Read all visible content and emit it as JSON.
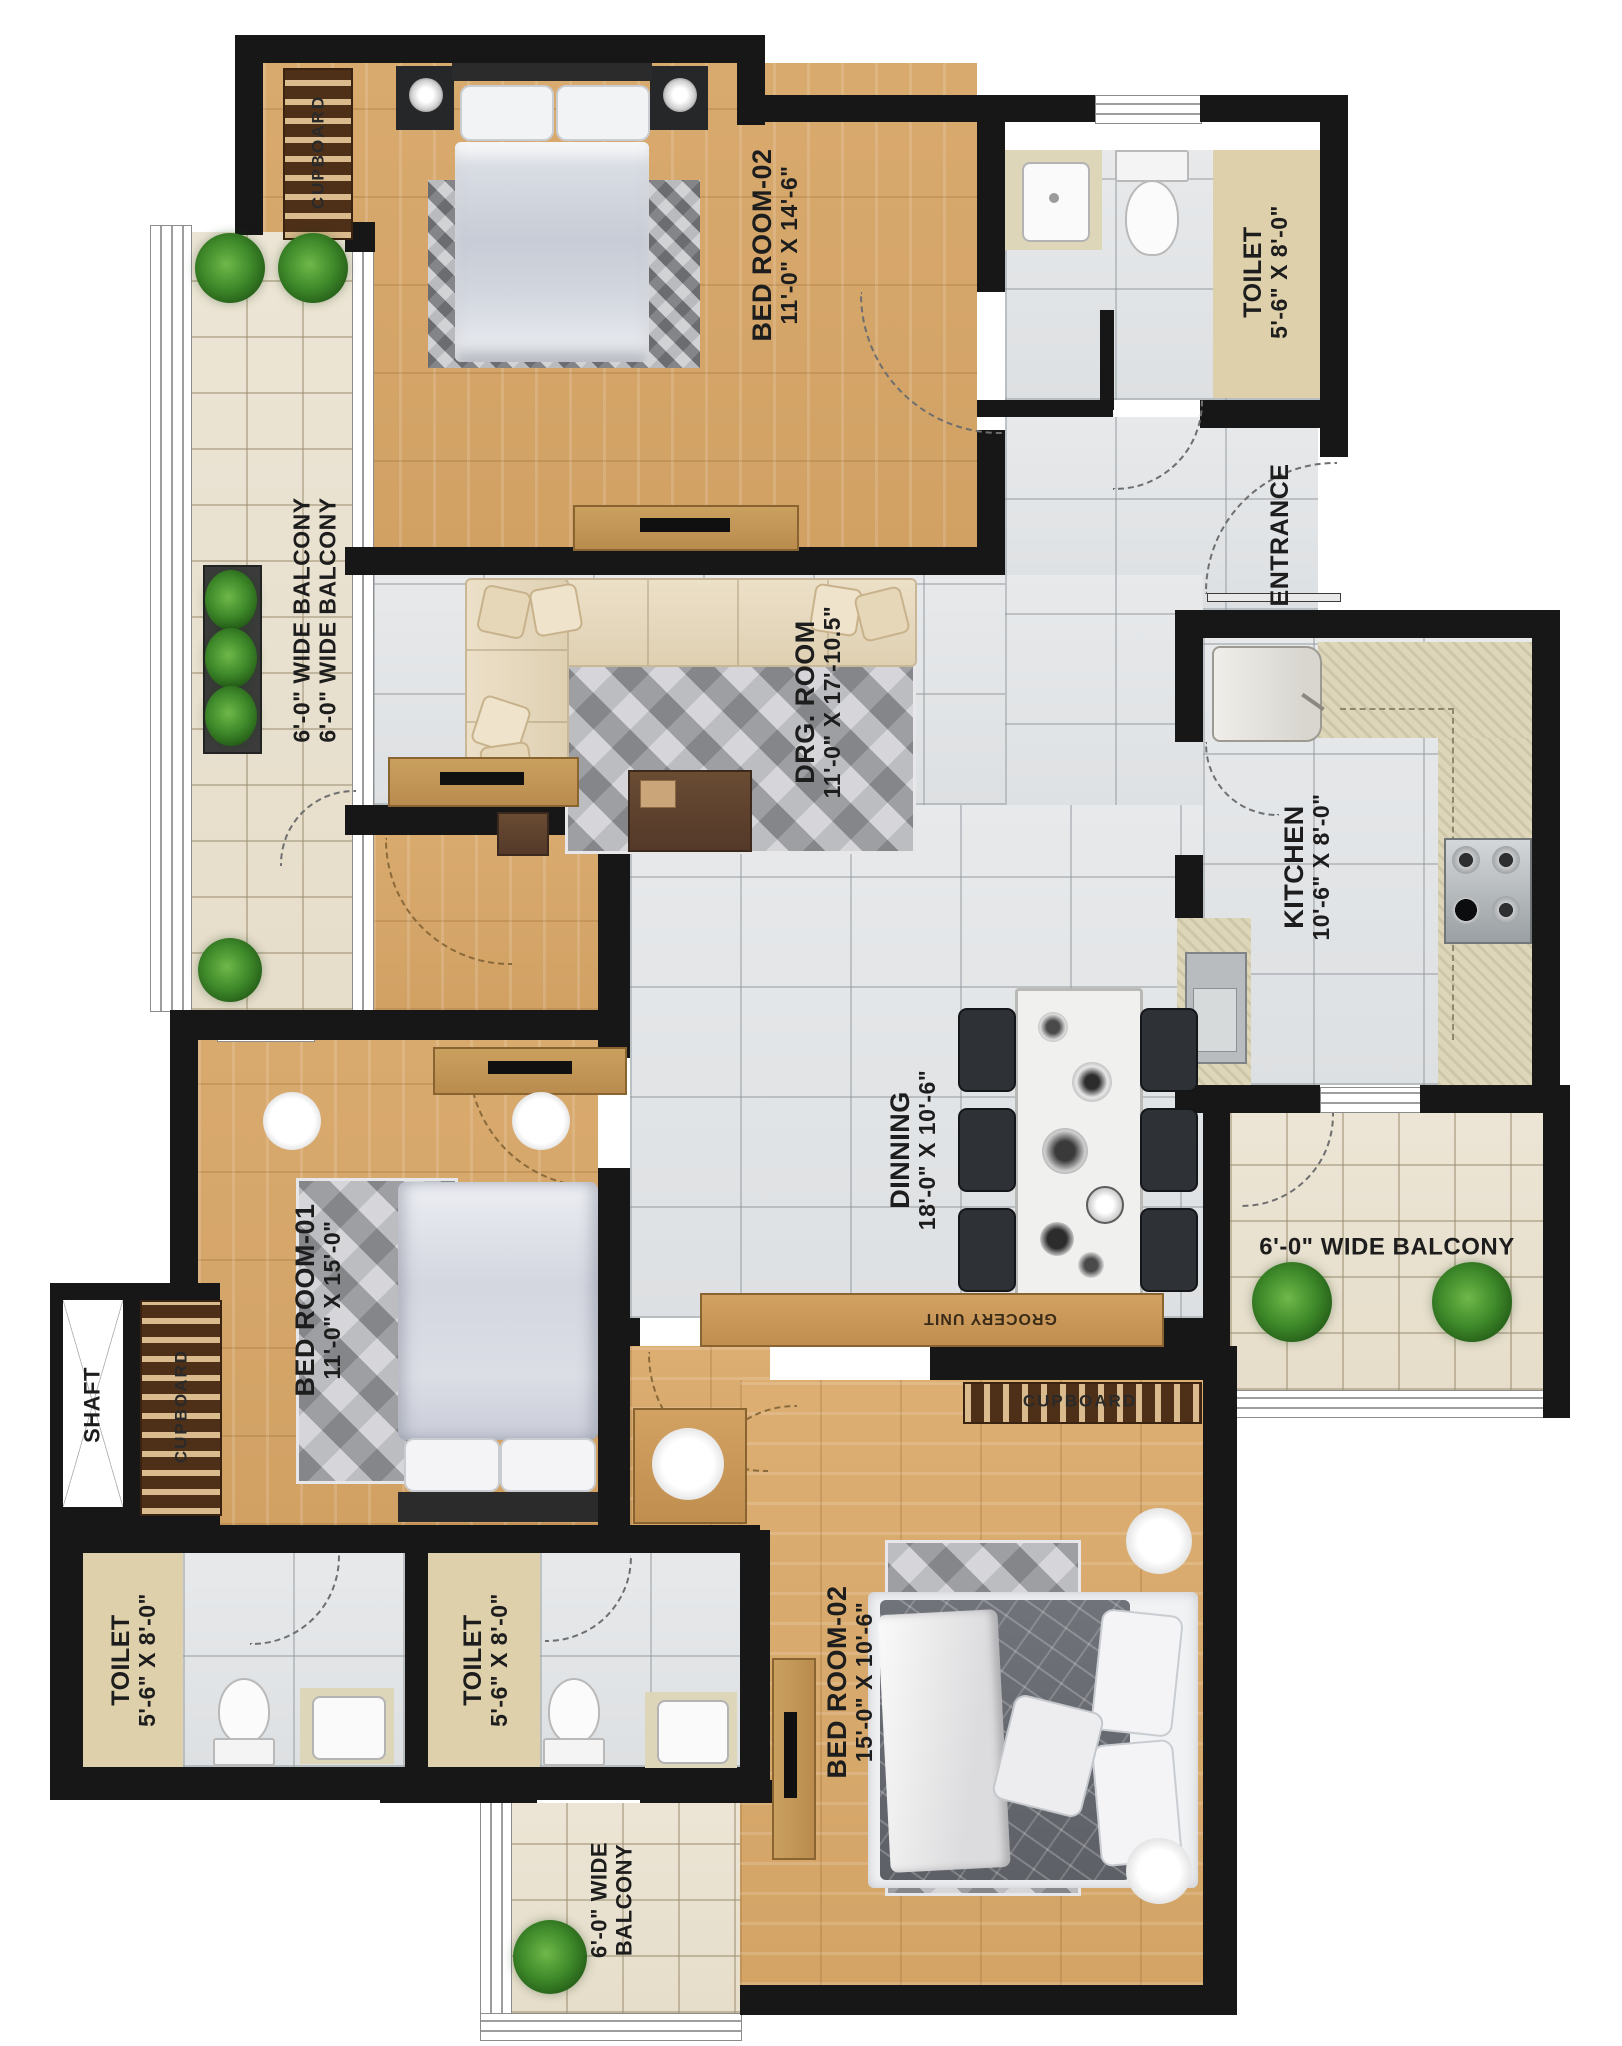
{
  "plan": {
    "bedroom_top": {
      "name": "BED ROOM-02",
      "dims": "11'-0\" X 14'-6\""
    },
    "bedroom_top_cupboard": "CUPBOARD",
    "toilet_top": {
      "name": "TOILET",
      "dims": "5'-6\" X 8'-0\""
    },
    "entrance": "ENTRANCE",
    "kitchen": {
      "name": "KITCHEN",
      "dims": "10'-6\" X 8'-0\""
    },
    "drg_room": {
      "name": "DRG. ROOM",
      "dims": "11'-0\" X 17'-10.5\""
    },
    "balcony_left": {
      "line1": "6'-0\" WIDE BALCONY",
      "line2": "6'-0\" WIDE BALCONY"
    },
    "dining": {
      "name": "DINNING",
      "dims": "18'-0\" X 10'-6\""
    },
    "grocery_unit": "GROCERY UNIT",
    "bedroom_one": {
      "name": "BED ROOM-01",
      "dims": "11'-0\" X 15'-0\""
    },
    "shaft": "SHAFT",
    "bedroom_one_cupboard": "CUPBOARD",
    "toilet_one": {
      "name": "TOILET",
      "dims": "5'-6\" X 8'-0\""
    },
    "toilet_two": {
      "name": "TOILET",
      "dims": "5'-6\" X 8'-0\""
    },
    "bedroom_bottom": {
      "name": "BED ROOM-02",
      "dims": "15'-0\" X 10'-6\""
    },
    "bedroom_bottom_cupboard": "CUPBOARD",
    "balcony_right": "6'-0\" WIDE BALCONY",
    "balcony_bottom": {
      "line1": "6'-0\" WIDE",
      "line2": "BALCONY"
    }
  },
  "colors": {
    "wall": "#171717",
    "wood_floor": "#d7a96d",
    "tile_floor": "#e2e4e6",
    "balcony_tile": "#eae3d2",
    "label_panel": "#ddd0ab",
    "counter": "#ded6b8",
    "cupboard": "#4e3018",
    "plant": "#3f8a2a",
    "text": "#1d1d1d"
  }
}
